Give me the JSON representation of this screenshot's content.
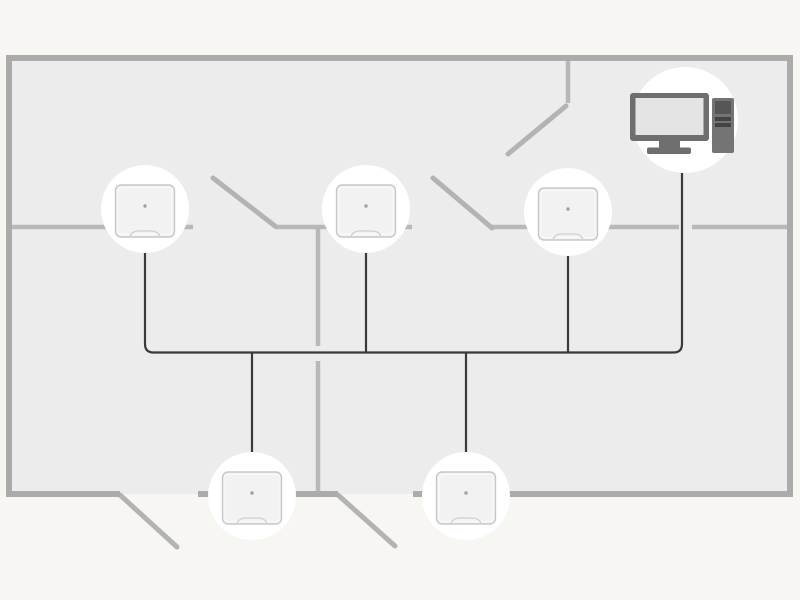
{
  "diagram": {
    "type": "floorplan-network",
    "canvas": {
      "width": 800,
      "height": 600
    },
    "colors": {
      "page_bg": "#f7f6f2",
      "floor": "#ebeceb",
      "outer_wall": "#ababab",
      "inner_wall": "#b8b8b8",
      "door": "#b3b3b3",
      "cable": "#3a3a3a",
      "halo": "#ffffff",
      "device_fill": "#f2f2f2",
      "device_border": "#c7c7c7",
      "device_inner_edge": "#fafafa",
      "device_dot": "#a0a0a0",
      "pc_body": "#6e6e6e",
      "pc_screen": "#e4e4e4",
      "pc_tower": "#747474",
      "pc_tower_top": "#565656",
      "pc_stripe": "#434343"
    },
    "stroke_widths": {
      "outer_wall": 6,
      "inner_wall": 4.5,
      "door": 5,
      "wire": 2.2
    },
    "floor": {
      "x": 9,
      "y": 58,
      "width": 781,
      "height": 436
    },
    "outer_walls": [
      [
        6,
        58,
        793,
        58
      ],
      [
        9,
        55,
        9,
        497
      ],
      [
        790,
        55,
        790,
        497
      ],
      [
        6,
        494,
        120,
        494
      ],
      [
        198,
        494,
        338,
        494
      ],
      [
        413,
        494,
        793,
        494
      ]
    ],
    "inner_walls": [
      [
        9,
        227,
        193,
        227
      ],
      [
        275,
        227,
        412,
        227
      ],
      [
        492,
        227,
        679,
        227
      ],
      [
        692,
        227,
        790,
        227
      ],
      [
        318,
        227,
        318,
        346
      ],
      [
        318,
        361,
        318,
        494
      ],
      [
        568,
        58,
        568,
        103
      ]
    ],
    "doors": [
      [
        213,
        178,
        275,
        226
      ],
      [
        433,
        178,
        492,
        228
      ],
      [
        566,
        106,
        508,
        154
      ],
      [
        120,
        495,
        177,
        547
      ],
      [
        338,
        495,
        395,
        546
      ]
    ],
    "cables": [
      "M 145 253 L 145 344 Q 145 352.5 153.5 352.5 L 673.5 352.5 Q 682 352.5 682 344 L 682 173",
      "M 366 253 L 366 353.5",
      "M 568 256 L 568 353.5",
      "M 252 352.5 L 252 452",
      "M 466 352.5 L 466 452"
    ],
    "devices": [
      {
        "id": "device-node-1",
        "cx": 145,
        "cy": 209,
        "r": 44
      },
      {
        "id": "device-node-2",
        "cx": 366,
        "cy": 209,
        "r": 44
      },
      {
        "id": "device-node-3",
        "cx": 568,
        "cy": 212,
        "r": 44
      },
      {
        "id": "device-node-4",
        "cx": 252,
        "cy": 496,
        "r": 44
      },
      {
        "id": "device-node-5",
        "cx": 466,
        "cy": 496,
        "r": 44
      }
    ],
    "device_glyph": {
      "w": 59,
      "h": 52,
      "rx": 5.5,
      "dy": 2,
      "dot_dy": -3,
      "dot_r": 1.7,
      "notch_half_w": 15,
      "notch_depth": 6
    },
    "computer": {
      "cx": 685,
      "cy": 120,
      "r": 53,
      "monitor": {
        "x": 630,
        "y": 93,
        "w": 79,
        "h": 48,
        "rx": 3
      },
      "screen": {
        "x": 635.5,
        "y": 98,
        "w": 68,
        "h": 37,
        "rx": 0
      },
      "neck": {
        "x": 659,
        "y": 140,
        "w": 21,
        "h": 9,
        "rx": 0
      },
      "base": {
        "x": 647,
        "y": 147.5,
        "w": 44,
        "h": 6.5,
        "rx": 2
      },
      "tower": {
        "x": 712,
        "y": 98,
        "w": 22,
        "h": 55,
        "rx": 2
      },
      "tower_top": {
        "x": 715,
        "y": 101,
        "w": 16,
        "h": 13,
        "rx": 0
      },
      "stripes": [
        {
          "x": 715,
          "y": 117,
          "w": 16,
          "h": 4,
          "rx": 0
        },
        {
          "x": 715,
          "y": 123,
          "w": 16,
          "h": 4,
          "rx": 0
        }
      ]
    }
  }
}
